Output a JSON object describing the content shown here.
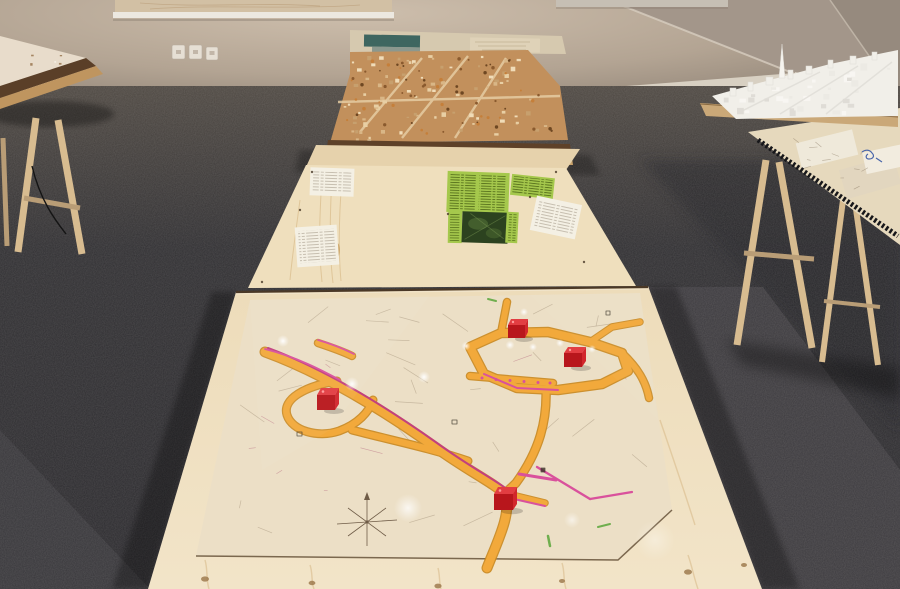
{
  "scene": {
    "title": "Exhibition room with urban-planning models and road-plan drawings on trestle tables",
    "elements": {
      "central_table": "long pine table run: road plan under glass (front), pinned papers and green cards (middle), cork city model (far end)",
      "left_table": "trestle table with pale relief model, partially visible",
      "right_table": "trestle table with white architectural model and documents under glass",
      "map_markers": "four glossy red cubes placed on the road plan",
      "wall": "beige gallery wall with framed drawing, wall plates and baseboard",
      "floor": "dark anthracite carpet"
    },
    "red_cube_count": 4
  },
  "palette": {
    "wall_light": "#cdbeac",
    "wall_mid": "#b3a493",
    "wall_dark": "#8b7f73",
    "wall_panel": "#a3968a",
    "wall_panel2": "#968a7e",
    "baseboard": "#d8d0c2",
    "frame_art": "#d2c0a4",
    "frame_bar": "#ece8e0",
    "carpet_top": "#4e4842",
    "carpet_mid": "#302f32",
    "carpet_dark": "#242327",
    "carpet_band": "#3e3c40",
    "pine": "#f2e4c8",
    "pine_deep": "#e6d2ac",
    "panel_pine": "#efdfbd",
    "grain": "#d8ba8a",
    "knot": "#9a7648",
    "sheet": "#ecdfc6",
    "sheet_edge": "#6e5a40",
    "road_fill": "#f2a93b",
    "road_casing": "#c9881f",
    "pink": "#d9519c",
    "pink_dark": "#c2407e",
    "green_mark": "#6fae4e",
    "line_faint": "#9b8a72",
    "cube_top": "#e23d42",
    "cube_front": "#b8161c",
    "cube_side": "#d2262c",
    "cork": "#c2905c",
    "cork_frame": "#5e4128",
    "cork_edge": "#c9a26a",
    "backboard": "#d6c9af",
    "teal_card": "#3e6660",
    "teal_card2": "#8c988e",
    "green_card": "#a5c84c",
    "green_card_text": "#4e6616",
    "photo_dark": "#2c421f",
    "paper": "#f4f0e4",
    "paper_line": "#8f8270",
    "white_model": "#f1efe9",
    "white_model_shade": "#dfdcd6",
    "trestle": "#d8bc90",
    "trestle_dark": "#b99d76",
    "wood_strip": "#5a3f28",
    "wood_strip2": "#bf955f",
    "doc_surface": "#e6d9bd",
    "doc_paper": "#efe9da",
    "doc_paper2": "#e2d6bf",
    "blue_ink": "#4a66aa",
    "zipper": "#17171a"
  },
  "textures": [
    {
      "target": "tex-cork-buildings",
      "kind": "rect",
      "count": 85,
      "min": 2,
      "max": 5,
      "quad": [
        [
          352,
          56
        ],
        [
          524,
          54
        ],
        [
          560,
          138
        ],
        [
          338,
          140
        ]
      ],
      "colors": [
        "#e8cfa4",
        "#d9b686",
        "#c7a06e",
        "#f0dcb8"
      ]
    },
    {
      "target": "tex-cork-trees",
      "kind": "dot",
      "count": 65,
      "min": 0.8,
      "max": 1.8,
      "quad": [
        [
          354,
          58
        ],
        [
          522,
          56
        ],
        [
          558,
          136
        ],
        [
          340,
          138
        ]
      ],
      "colors": [
        "#8a5a2e",
        "#c57f3a",
        "#6e4722"
      ]
    },
    {
      "target": "tex-white-blocks",
      "kind": "rect",
      "count": 34,
      "min": 3,
      "max": 8,
      "quad": [
        [
          718,
          96
        ],
        [
          890,
          54
        ],
        [
          890,
          110
        ],
        [
          736,
          114
        ]
      ],
      "colors": [
        "#f8f6f2",
        "#eceae4",
        "#dfdcd6"
      ]
    },
    {
      "target": "tex-sheet-lines",
      "kind": "line",
      "count": 30,
      "min": 0.7,
      "max": 30,
      "opacity": 0.45,
      "quad": [
        [
          258,
          306
        ],
        [
          628,
          300
        ],
        [
          656,
          500
        ],
        [
          208,
          545
        ]
      ],
      "colors": [
        "#9b8a72"
      ]
    },
    {
      "target": "tex-sheet-lines-red",
      "kind": "line",
      "count": 8,
      "min": 0.6,
      "max": 22,
      "opacity": 0.5,
      "quad": [
        [
          270,
          315
        ],
        [
          620,
          308
        ],
        [
          645,
          490
        ],
        [
          220,
          535
        ]
      ],
      "colors": [
        "#b2607a"
      ]
    },
    {
      "target": "tex-left-speckles",
      "kind": "rect",
      "count": 16,
      "min": 1.5,
      "max": 3,
      "quad": [
        [
          4,
          42
        ],
        [
          78,
          58
        ],
        [
          40,
          92
        ],
        [
          2,
          84
        ]
      ],
      "colors": [
        "#8a6848",
        "#a58562",
        "#f8f2e8"
      ]
    },
    {
      "target": "tex-doc-lines",
      "kind": "line",
      "count": 12,
      "min": 0.6,
      "max": 9,
      "opacity": 0.55,
      "quad": [
        [
          798,
          142
        ],
        [
          884,
          156
        ],
        [
          892,
          214
        ],
        [
          806,
          172
        ]
      ],
      "colors": [
        "#8a7a64"
      ]
    }
  ]
}
